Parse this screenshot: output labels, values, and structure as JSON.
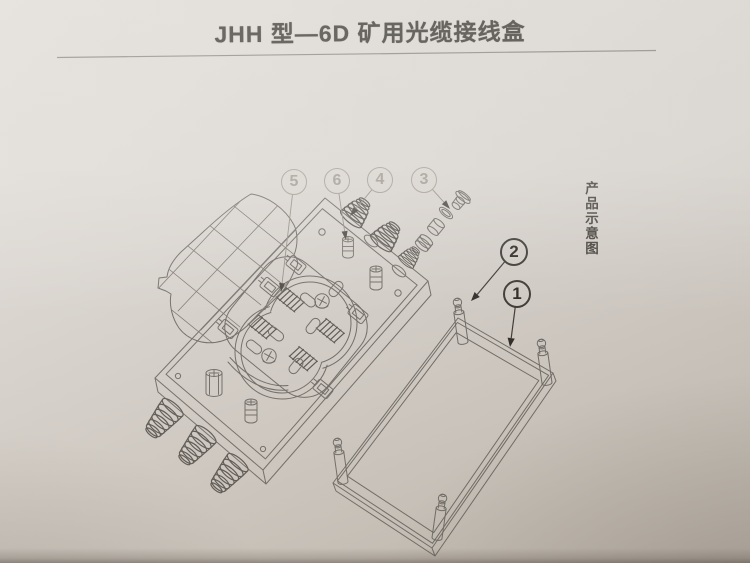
{
  "page": {
    "title": "JHH 型—6D 矿用光缆接线盒",
    "side_caption": "产品示意图"
  },
  "callouts": [
    {
      "label": "5"
    },
    {
      "label": "6"
    },
    {
      "label": "4"
    },
    {
      "label": "3"
    },
    {
      "label": "2"
    },
    {
      "label": "1"
    }
  ],
  "colors": {
    "paper_light": "#ded9d3",
    "paper_dark": "#bfb7ad",
    "line": "#6e6963",
    "callout_faded": "#a49d93",
    "callout_dark": "#29261f",
    "title_text": "#3b3731"
  }
}
